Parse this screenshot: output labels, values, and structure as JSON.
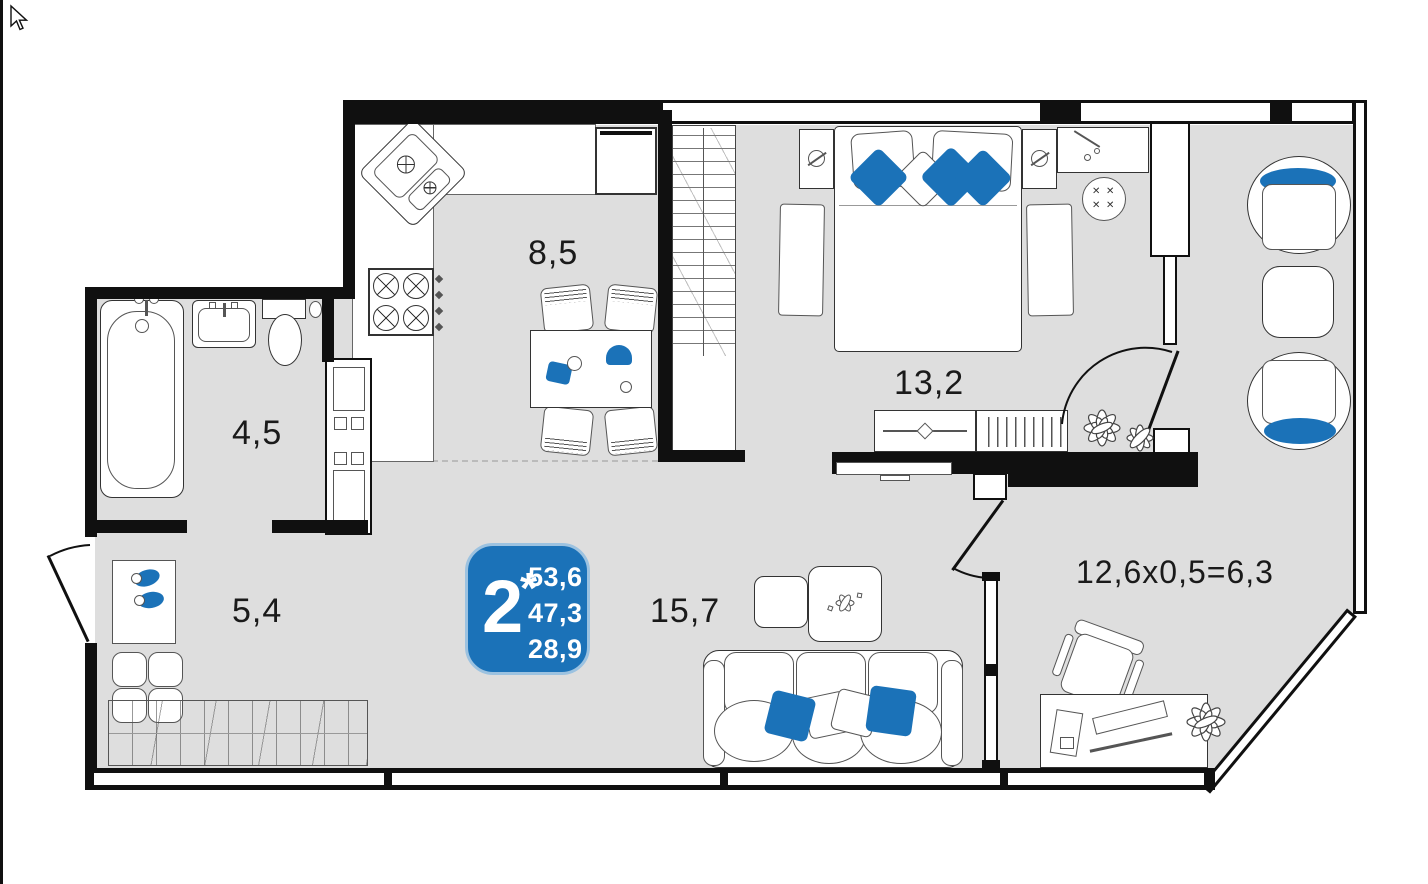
{
  "plan": {
    "type": "apartment-floor-plan",
    "rooms": {
      "kitchen": {
        "label": "8,5"
      },
      "bedroom": {
        "label": "13,2"
      },
      "bathroom": {
        "label": "4,5"
      },
      "hallway": {
        "label": "5,4"
      },
      "living": {
        "label": "15,7"
      },
      "balcony": {
        "label": "12,6x0,5=6,3"
      }
    },
    "badge": {
      "rooms": "2",
      "asterisk": "*",
      "values": [
        "53,6",
        "47,3",
        "28,9"
      ]
    },
    "colors": {
      "accent_blue": "#1b72b8",
      "floor_gray": "#dedede",
      "wall_black": "#101010",
      "outline": "#333333"
    },
    "glyphs": {
      "cross": "✕"
    }
  }
}
